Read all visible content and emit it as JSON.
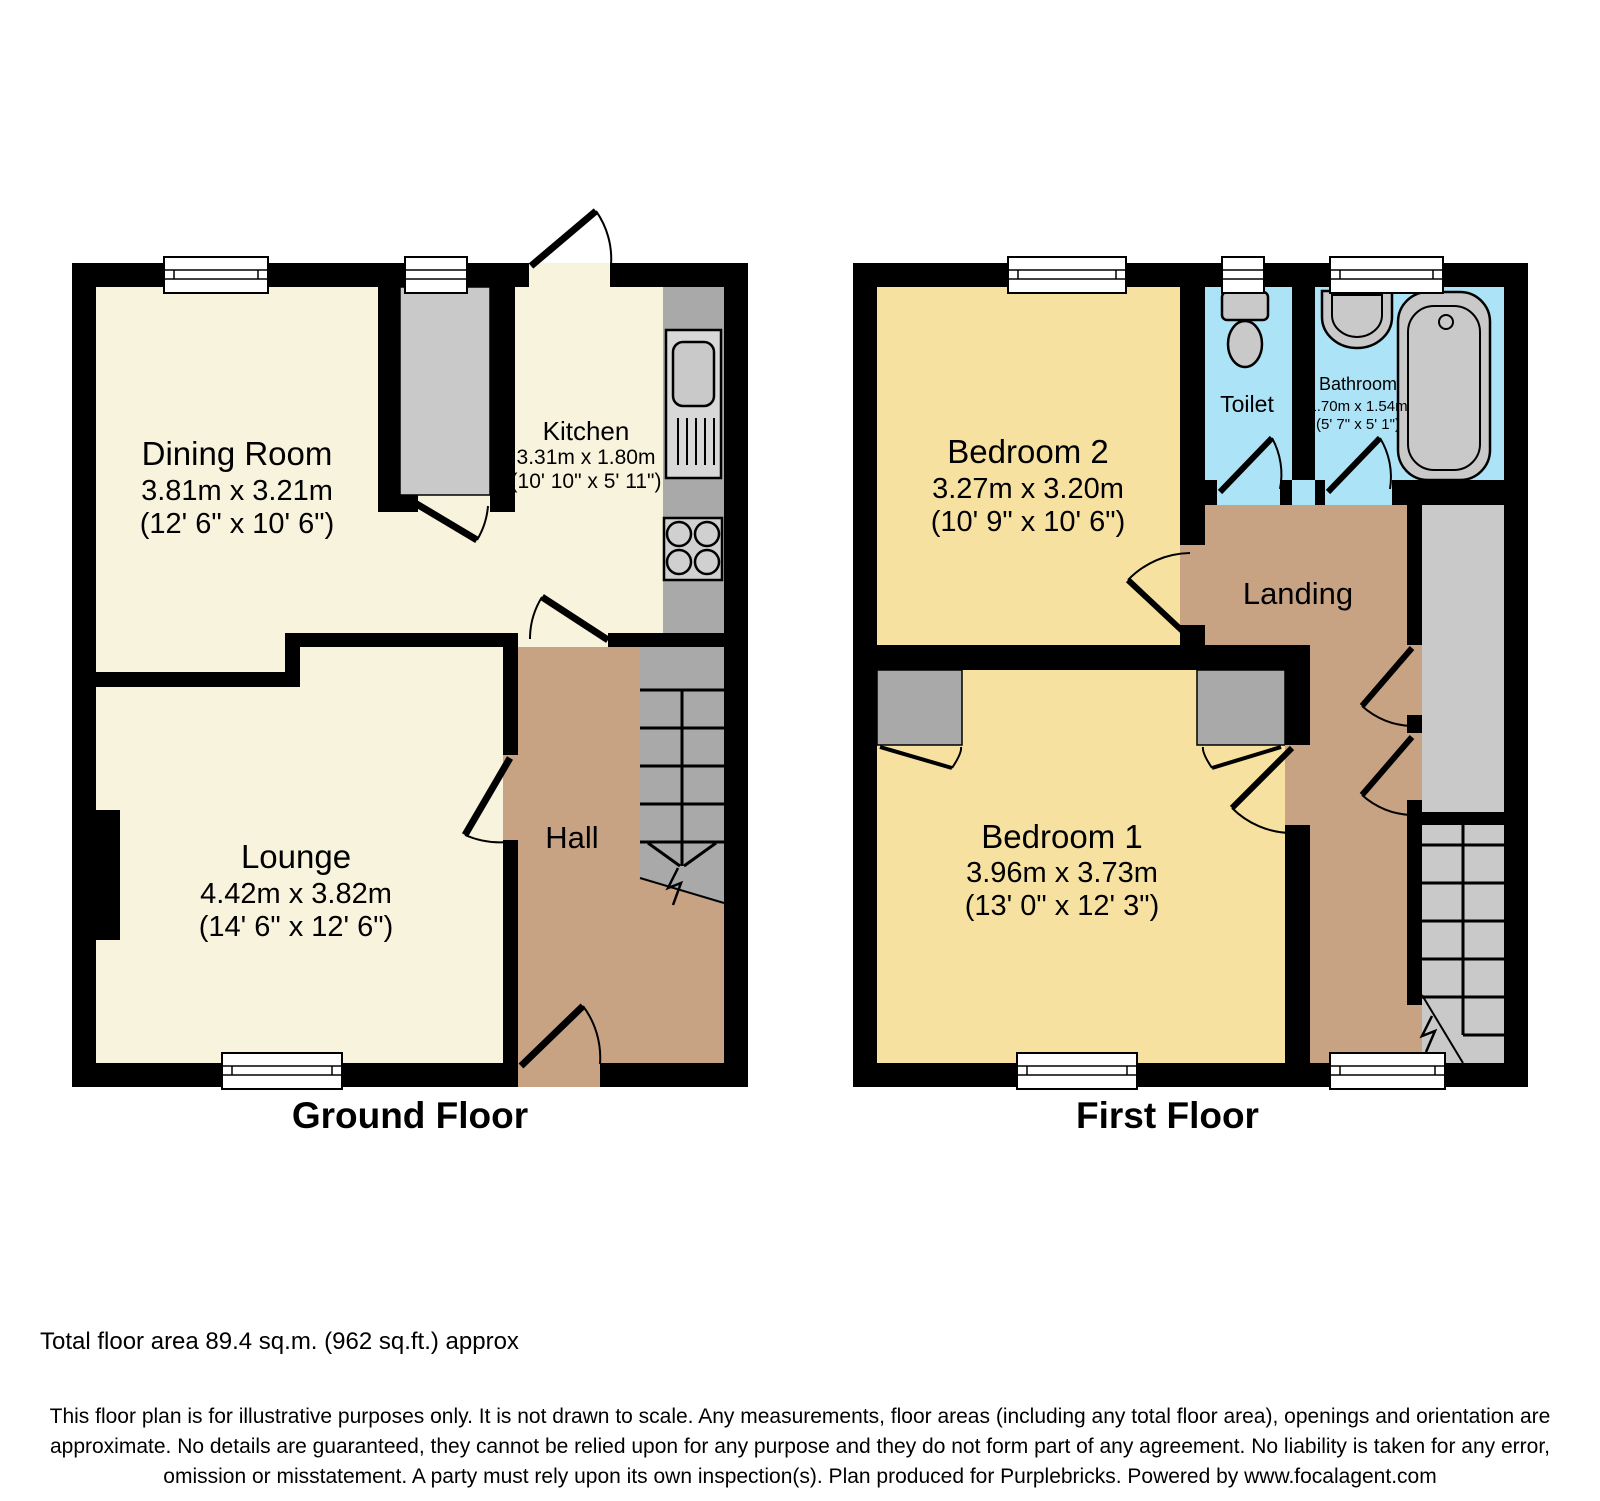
{
  "ground": {
    "title": "Ground Floor",
    "dining": {
      "name": "Dining Room",
      "metric": "3.81m x 3.21m",
      "imperial": "(12' 6\" x 10' 6\")"
    },
    "kitchen": {
      "name": "Kitchen",
      "metric": "3.31m x 1.80m",
      "imperial": "(10' 10\" x 5' 11\")"
    },
    "lounge": {
      "name": "Lounge",
      "metric": "4.42m x 3.82m",
      "imperial": "(14' 6\" x 12' 6\")"
    },
    "hall": {
      "name": "Hall"
    }
  },
  "first": {
    "title": "First Floor",
    "bedroom2": {
      "name": "Bedroom 2",
      "metric": "3.27m x 3.20m",
      "imperial": "(10' 9\" x 10' 6\")"
    },
    "toilet": {
      "name": "Toilet"
    },
    "bathroom": {
      "name": "Bathroom",
      "metric": "1.70m x 1.54m",
      "imperial": "(5' 7\" x 5' 1\")"
    },
    "landing": {
      "name": "Landing"
    },
    "bedroom1": {
      "name": "Bedroom 1",
      "metric": "3.96m x 3.73m",
      "imperial": "(13' 0\" x 12' 3\")"
    }
  },
  "footer": {
    "total_area": "Total floor area 89.4 sq.m. (962 sq.ft.) approx",
    "disclaimer": "This floor plan is for illustrative purposes only. It is not drawn to scale. Any measurements, floor areas (including any total floor area), openings and orientation are approximate. No details are guaranteed, they cannot be relied upon for any purpose and they do not form part of any agreement. No liability is taken for any error, omission or misstatement. A party must rely upon its own inspection(s). Plan produced for Purplebricks. Powered by www.focalagent.com"
  },
  "colors": {
    "wall": "#000000",
    "ground_room": "#F8F3DC",
    "bedroom": "#F6E1A0",
    "hall_landing": "#C7A384",
    "wet_room": "#ACE3F6",
    "stairs_dark": "#A9A9A9",
    "stairs_light": "#C9C9C9",
    "fixture": "#CFCFCF",
    "window": "#FFFFFF"
  }
}
